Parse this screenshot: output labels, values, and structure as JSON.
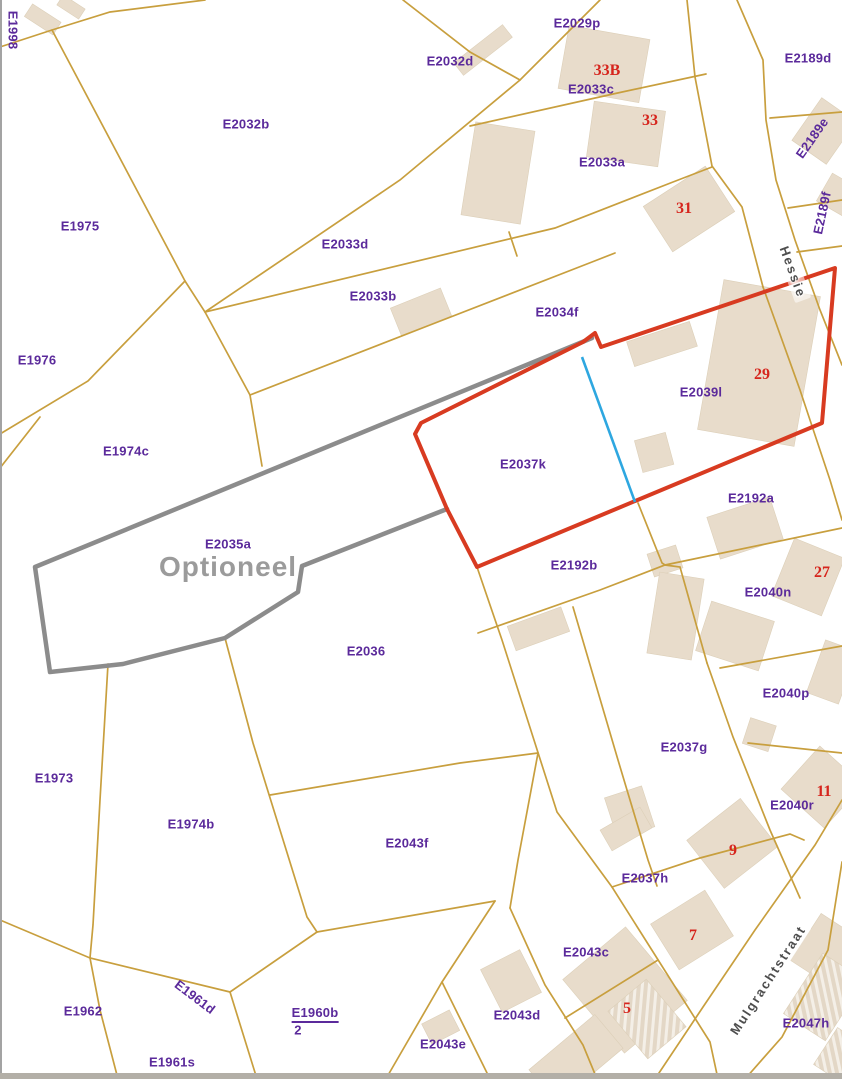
{
  "map": {
    "title": "Cadastral parcel map",
    "overlay": {
      "optional_area_label": "Optioneel",
      "selected_parcel_outline_color": "#d83b21",
      "optional_area_outline_color": "#8c8c8c",
      "blue_boundary_color": "#2ea7e0",
      "parcel_line_color": "#c89f3e",
      "building_fill_color": "#e8dccb",
      "parcel_label_color": "#5b2a9b",
      "house_number_color": "#d6251d"
    },
    "streets": [
      "Hessie",
      "Mulgrachtstraat"
    ],
    "labels": [
      {
        "kind": "parcel",
        "text": "E1998",
        "x": 13,
        "y": 30,
        "rot": 90
      },
      {
        "kind": "parcel",
        "text": "E2029p",
        "x": 577,
        "y": 23
      },
      {
        "kind": "parcel",
        "text": "E2032d",
        "x": 450,
        "y": 61
      },
      {
        "kind": "parcel",
        "text": "E2033c",
        "x": 591,
        "y": 89
      },
      {
        "kind": "parcel",
        "text": "E2032b",
        "x": 246,
        "y": 124
      },
      {
        "kind": "parcel",
        "text": "E2033a",
        "x": 602,
        "y": 162
      },
      {
        "kind": "parcel",
        "text": "E2189d",
        "x": 808,
        "y": 58
      },
      {
        "kind": "parcel",
        "text": "E2189e",
        "x": 812,
        "y": 138,
        "rot": -55
      },
      {
        "kind": "parcel",
        "text": "E2189f",
        "x": 822,
        "y": 213,
        "rot": -78
      },
      {
        "kind": "parcel",
        "text": "E1975",
        "x": 80,
        "y": 226
      },
      {
        "kind": "parcel",
        "text": "E2033d",
        "x": 345,
        "y": 244
      },
      {
        "kind": "parcel",
        "text": "E2033b",
        "x": 373,
        "y": 296
      },
      {
        "kind": "parcel",
        "text": "E2034f",
        "x": 557,
        "y": 312
      },
      {
        "kind": "parcel",
        "text": "E1976",
        "x": 37,
        "y": 360
      },
      {
        "kind": "parcel",
        "text": "E2039l",
        "x": 701,
        "y": 392
      },
      {
        "kind": "parcel",
        "text": "E1974c",
        "x": 126,
        "y": 451
      },
      {
        "kind": "parcel",
        "text": "E2037k",
        "x": 523,
        "y": 464
      },
      {
        "kind": "parcel",
        "text": "E2192a",
        "x": 751,
        "y": 498
      },
      {
        "kind": "parcel",
        "text": "E2035a",
        "x": 228,
        "y": 544
      },
      {
        "kind": "parcel",
        "text": "E2192b",
        "x": 574,
        "y": 565
      },
      {
        "kind": "parcel",
        "text": "E2040n",
        "x": 768,
        "y": 592
      },
      {
        "kind": "parcel",
        "text": "E2036",
        "x": 366,
        "y": 651
      },
      {
        "kind": "parcel",
        "text": "E2040p",
        "x": 786,
        "y": 693
      },
      {
        "kind": "parcel",
        "text": "E2037g",
        "x": 684,
        "y": 747
      },
      {
        "kind": "parcel",
        "text": "E1973",
        "x": 54,
        "y": 778
      },
      {
        "kind": "parcel",
        "text": "E2040r",
        "x": 792,
        "y": 805
      },
      {
        "kind": "parcel",
        "text": "E1974b",
        "x": 191,
        "y": 824
      },
      {
        "kind": "parcel",
        "text": "E2043f",
        "x": 407,
        "y": 843
      },
      {
        "kind": "parcel",
        "text": "E2037h",
        "x": 645,
        "y": 878
      },
      {
        "kind": "parcel",
        "text": "E2043c",
        "x": 586,
        "y": 952
      },
      {
        "kind": "parcel",
        "text": "E1961d",
        "x": 195,
        "y": 997,
        "rot": 37
      },
      {
        "kind": "parcel",
        "text": "E1962",
        "x": 83,
        "y": 1011
      },
      {
        "kind": "parcel",
        "text": "E1960b",
        "x": 315,
        "y": 1014,
        "underline": true
      },
      {
        "kind": "parcel",
        "text": "2",
        "x": 298,
        "y": 1030
      },
      {
        "kind": "parcel",
        "text": "E2043d",
        "x": 517,
        "y": 1015
      },
      {
        "kind": "parcel",
        "text": "E2047h",
        "x": 806,
        "y": 1023
      },
      {
        "kind": "parcel",
        "text": "E2043e",
        "x": 443,
        "y": 1044
      },
      {
        "kind": "parcel",
        "text": "E1961s",
        "x": 172,
        "y": 1062
      },
      {
        "kind": "house",
        "text": "33B",
        "x": 607,
        "y": 71
      },
      {
        "kind": "house",
        "text": "33",
        "x": 650,
        "y": 121
      },
      {
        "kind": "house",
        "text": "31",
        "x": 684,
        "y": 209
      },
      {
        "kind": "house",
        "text": "29",
        "x": 762,
        "y": 375
      },
      {
        "kind": "house",
        "text": "27",
        "x": 822,
        "y": 573
      },
      {
        "kind": "house",
        "text": "11",
        "x": 824,
        "y": 792
      },
      {
        "kind": "house",
        "text": "9",
        "x": 733,
        "y": 851
      },
      {
        "kind": "house",
        "text": "7",
        "x": 693,
        "y": 936
      },
      {
        "kind": "house",
        "text": "5",
        "x": 627,
        "y": 1009
      },
      {
        "kind": "street",
        "text": "Hessie",
        "x": 793,
        "y": 272,
        "rot": 70
      },
      {
        "kind": "street",
        "text": "Mulgrachtstraat",
        "x": 768,
        "y": 980,
        "rot": -57
      },
      {
        "kind": "note",
        "text": "Optioneel",
        "x": 228,
        "y": 567
      }
    ]
  }
}
